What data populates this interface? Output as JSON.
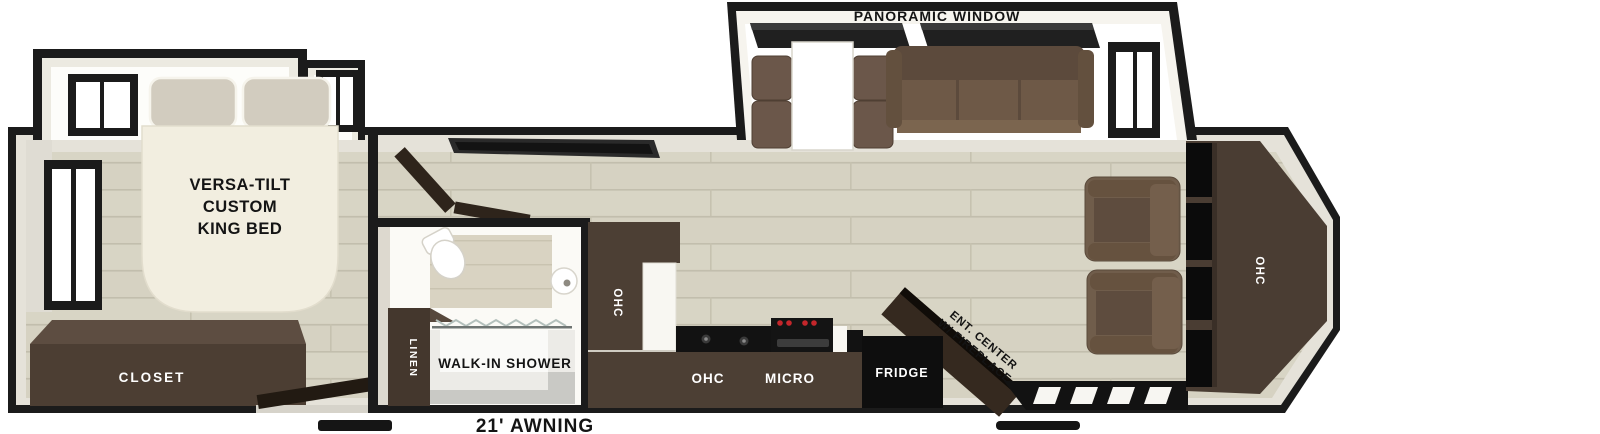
{
  "plan": {
    "type": "rv-travel-trailer-floorplan",
    "labels": {
      "panoramic_window": "PANORAMIC WINDOW",
      "awning": "21' AWNING"
    },
    "bedroom": {
      "bed_line1": "VERSA-TILT",
      "bed_line2": "CUSTOM",
      "bed_line3": "KING BED",
      "closet": "CLOSET"
    },
    "bathroom": {
      "linen": "LINEN",
      "shower": "WALK-IN SHOWER"
    },
    "kitchen": {
      "pantry_ohc": "OHC",
      "counter_ohc": "OHC",
      "micro": "MICRO",
      "fridge": "FRIDGE"
    },
    "living": {
      "ent_line1": "ENT. CENTER",
      "ent_line2": "W/ FIREPLACE",
      "rear_ohc": "OHC"
    },
    "colors": {
      "wall": "#1b1b1b",
      "wall_band": "#e5e2d9",
      "floor": "#d6d2c2",
      "floor_line": "#c2bead",
      "cabinet_dark": "#4c3f34",
      "cabinet_top": "#5d4d41",
      "sofa": "#6f5a48",
      "appliance_black": "#0e0e0e",
      "bed_cream": "#f2eee0",
      "pillow": "#d2ccbf",
      "cooktop_knob": "#c4262b",
      "slide_interior": "#ffffff"
    }
  }
}
